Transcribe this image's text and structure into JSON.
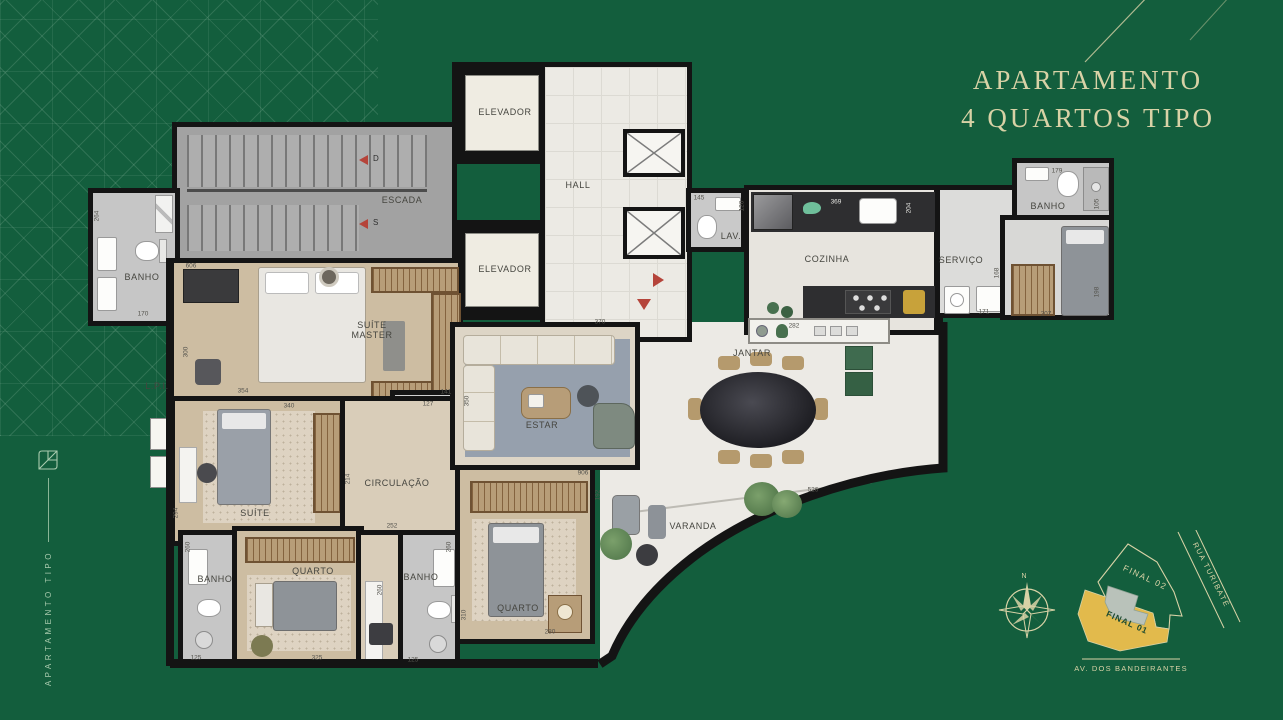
{
  "title": {
    "line1": "APARTAMENTO",
    "line2": "4 QUARTOS TIPO"
  },
  "side_branding": {
    "vertical_label": "APARTAMENTO TIPO"
  },
  "floor_plan": {
    "room_labels": [
      {
        "name": "escada",
        "label": "ESCADA",
        "x": 402,
        "y": 200
      },
      {
        "name": "elevador-1",
        "label": "ELEVADOR",
        "x": 505,
        "y": 112
      },
      {
        "name": "elevador-2",
        "label": "ELEVADOR",
        "x": 505,
        "y": 269
      },
      {
        "name": "hall",
        "label": "HALL",
        "x": 578,
        "y": 185
      },
      {
        "name": "lav",
        "label": "LAV.",
        "x": 731,
        "y": 236
      },
      {
        "name": "cozinha",
        "label": "COZINHA",
        "x": 827,
        "y": 259
      },
      {
        "name": "servico",
        "label": "SERVIÇO",
        "x": 961,
        "y": 260
      },
      {
        "name": "banho-suite-master",
        "label": "BANHO",
        "x": 142,
        "y": 277
      },
      {
        "name": "banho-servico",
        "label": "BANHO",
        "x": 1048,
        "y": 206
      },
      {
        "name": "suite-master",
        "label": "SUÍTE\nMASTER",
        "x": 372,
        "y": 330
      },
      {
        "name": "lpi",
        "label": "L.P.I.",
        "x": 157,
        "y": 386
      },
      {
        "name": "suite",
        "label": "SUÍTE",
        "x": 255,
        "y": 513
      },
      {
        "name": "circulacao",
        "label": "CIRCULAÇÃO",
        "x": 397,
        "y": 483
      },
      {
        "name": "banho-3",
        "label": "BANHO",
        "x": 215,
        "y": 579
      },
      {
        "name": "quarto-1",
        "label": "QUARTO",
        "x": 313,
        "y": 571
      },
      {
        "name": "banho-4",
        "label": "BANHO",
        "x": 421,
        "y": 577
      },
      {
        "name": "quarto-2",
        "label": "QUARTO",
        "x": 518,
        "y": 608
      },
      {
        "name": "estar",
        "label": "ESTAR",
        "x": 542,
        "y": 425
      },
      {
        "name": "jantar",
        "label": "JANTAR",
        "x": 752,
        "y": 353
      },
      {
        "name": "varanda",
        "label": "VARANDA",
        "x": 693,
        "y": 526
      }
    ],
    "stair_arrows": [
      {
        "label": "D"
      },
      {
        "label": "S"
      }
    ],
    "dimensions_cm": [
      {
        "value": "264",
        "x": 97,
        "y": 216,
        "vertical": true
      },
      {
        "value": "170",
        "x": 143,
        "y": 314
      },
      {
        "value": "606",
        "x": 191,
        "y": 266
      },
      {
        "value": "300",
        "x": 186,
        "y": 352,
        "vertical": true
      },
      {
        "value": "354",
        "x": 243,
        "y": 391
      },
      {
        "value": "340",
        "x": 289,
        "y": 406
      },
      {
        "value": "141",
        "x": 446,
        "y": 392
      },
      {
        "value": "127",
        "x": 428,
        "y": 404
      },
      {
        "value": "350",
        "x": 467,
        "y": 401,
        "vertical": true
      },
      {
        "value": "370",
        "x": 600,
        "y": 322
      },
      {
        "value": "294",
        "x": 176,
        "y": 513,
        "vertical": true
      },
      {
        "value": "214",
        "x": 348,
        "y": 479,
        "vertical": true
      },
      {
        "value": "252",
        "x": 392,
        "y": 526
      },
      {
        "value": "260",
        "x": 188,
        "y": 547,
        "vertical": true
      },
      {
        "value": "125",
        "x": 196,
        "y": 658
      },
      {
        "value": "325",
        "x": 317,
        "y": 658
      },
      {
        "value": "260",
        "x": 380,
        "y": 590,
        "vertical": true
      },
      {
        "value": "260",
        "x": 449,
        "y": 547,
        "vertical": true
      },
      {
        "value": "310",
        "x": 464,
        "y": 615,
        "vertical": true
      },
      {
        "value": "125",
        "x": 413,
        "y": 660
      },
      {
        "value": "280",
        "x": 550,
        "y": 632
      },
      {
        "value": "906",
        "x": 583,
        "y": 473
      },
      {
        "value": "192",
        "x": 598,
        "y": 495,
        "vertical": true
      },
      {
        "value": "526",
        "x": 813,
        "y": 490
      },
      {
        "value": "145",
        "x": 699,
        "y": 198
      },
      {
        "value": "120",
        "x": 742,
        "y": 206,
        "vertical": true
      },
      {
        "value": "369",
        "x": 836,
        "y": 202,
        "light": true
      },
      {
        "value": "204",
        "x": 909,
        "y": 208,
        "vertical": true,
        "light": true
      },
      {
        "value": "282",
        "x": 794,
        "y": 326
      },
      {
        "value": "171",
        "x": 984,
        "y": 312
      },
      {
        "value": "168",
        "x": 997,
        "y": 273,
        "vertical": true
      },
      {
        "value": "207",
        "x": 1046,
        "y": 314
      },
      {
        "value": "198",
        "x": 1097,
        "y": 292,
        "vertical": true
      },
      {
        "value": "179",
        "x": 1057,
        "y": 171
      },
      {
        "value": "105",
        "x": 1097,
        "y": 204,
        "vertical": true
      }
    ]
  },
  "site_map": {
    "north_label": "N",
    "final_01": "FINAL 01",
    "final_02": "FINAL 02",
    "street_1": "RUA TURIBATÉ",
    "street_2": "AV. DOS BANDEIRANTES"
  },
  "colors": {
    "background_green": "#135e3d",
    "title_gold": "#d8d2a6",
    "accent_red": "#b5443a",
    "site_plan_yellow": "#e2ba4c",
    "wall_black": "#141414"
  }
}
